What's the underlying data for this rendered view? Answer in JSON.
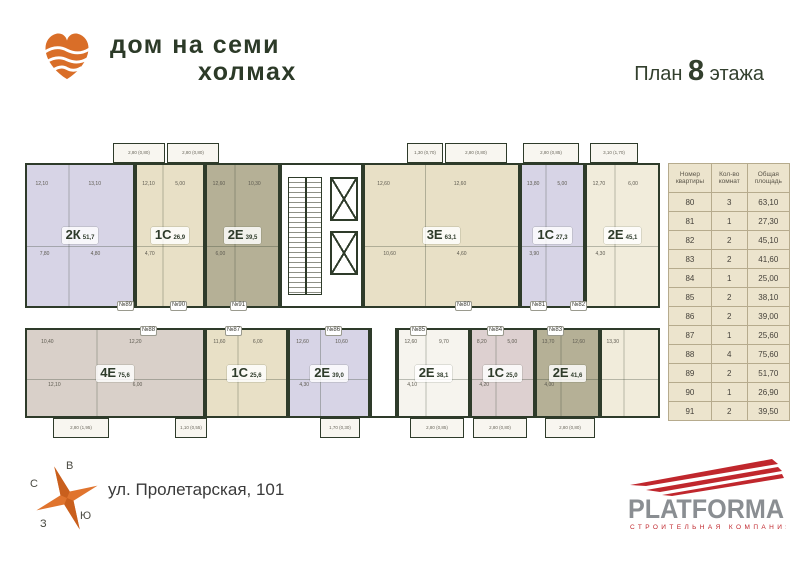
{
  "header": {
    "brand_line1": "дом на семи",
    "brand_line2": "холмах",
    "plan_prefix": "План",
    "plan_number": "8",
    "plan_suffix": "этажа"
  },
  "floor_plan": {
    "apartments": [
      {
        "door": "№89",
        "type": "2К",
        "area": "51,7",
        "color": "lavender",
        "x": 0,
        "y": 20,
        "w": 110,
        "h": 145,
        "rooms": [
          "12,10",
          "13,10",
          "7,80",
          "4,80"
        ],
        "doorx": 92,
        "doory": 158
      },
      {
        "door": "№90",
        "type": "1С",
        "area": "26,9",
        "color": "beige",
        "x": 110,
        "y": 20,
        "w": 70,
        "h": 145,
        "rooms": [
          "12,10",
          "5,00",
          "4,70"
        ],
        "doorx": 145,
        "doory": 158
      },
      {
        "door": "№91",
        "type": "2Е",
        "area": "39,5",
        "color": "olive",
        "x": 180,
        "y": 20,
        "w": 75,
        "h": 145,
        "rooms": [
          "12,60",
          "10,30",
          "6,00"
        ],
        "doorx": 205,
        "doory": 158
      },
      {
        "door": "№80",
        "type": "3Е",
        "area": "63,1",
        "color": "beige",
        "x": 338,
        "y": 20,
        "w": 157,
        "h": 145,
        "rooms": [
          "12,60",
          "12,60",
          "10,60",
          "4,60"
        ],
        "doorx": 430,
        "doory": 158
      },
      {
        "door": "№81",
        "type": "1С",
        "area": "27,3",
        "color": "lavender",
        "x": 495,
        "y": 20,
        "w": 65,
        "h": 145,
        "rooms": [
          "13,80",
          "5,00",
          "3,90"
        ],
        "doorx": 505,
        "doory": 158
      },
      {
        "door": "№82",
        "type": "2Е",
        "area": "45,1",
        "color": "cream",
        "x": 560,
        "y": 20,
        "w": 75,
        "h": 145,
        "rooms": [
          "12,70",
          "6,00",
          "4,30"
        ],
        "doorx": 545,
        "doory": 158
      },
      {
        "door": "№88",
        "type": "4Е",
        "area": "75,6",
        "color": "taupe",
        "x": 0,
        "y": 185,
        "w": 180,
        "h": 90,
        "rooms": [
          "10,40",
          "12,20",
          "12,10",
          "6,00"
        ],
        "doorx": 115,
        "doory": 183
      },
      {
        "door": "№87",
        "type": "1С",
        "area": "25,6",
        "color": "beige",
        "x": 180,
        "y": 185,
        "w": 83,
        "h": 90,
        "rooms": [
          "11,60",
          "6,00"
        ],
        "doorx": 200,
        "doory": 183
      },
      {
        "door": "№86",
        "type": "2Е",
        "area": "39,0",
        "color": "lavender",
        "x": 263,
        "y": 185,
        "w": 82,
        "h": 90,
        "rooms": [
          "12,60",
          "10,60",
          "4,30"
        ],
        "doorx": 300,
        "doory": 183
      },
      {
        "door": "№85",
        "type": "2Е",
        "area": "38,1",
        "color": "white",
        "x": 372,
        "y": 185,
        "w": 73,
        "h": 90,
        "rooms": [
          "12,60",
          "9,70",
          "4,10"
        ],
        "doorx": 385,
        "doory": 183
      },
      {
        "door": "№84",
        "type": "1С",
        "area": "25,0",
        "color": "pink",
        "x": 445,
        "y": 185,
        "w": 65,
        "h": 90,
        "rooms": [
          "8,20",
          "5,00",
          "4,20"
        ],
        "doorx": 462,
        "doory": 183
      },
      {
        "door": "№83",
        "type": "2Е",
        "area": "41,6",
        "color": "olive",
        "x": 510,
        "y": 185,
        "w": 65,
        "h": 90,
        "rooms": [
          "13,70",
          "12,60",
          "4,00"
        ],
        "doorx": 522,
        "doory": 183
      }
    ],
    "extra_blocks": [
      {
        "color": "cream",
        "x": 575,
        "y": 185,
        "w": 60,
        "h": 90,
        "rooms": [
          "13,30"
        ]
      }
    ],
    "lobby": {
      "x": 345,
      "y": 185,
      "w": 27,
      "h": 90
    },
    "balconies_top": [
      {
        "x": 88,
        "w": 52,
        "label": "2,80 (0,80)"
      },
      {
        "x": 142,
        "w": 52,
        "label": "2,80 (0,80)"
      },
      {
        "x": 382,
        "w": 36,
        "label": "1,30 (0,70)"
      },
      {
        "x": 420,
        "w": 62,
        "label": "2,80 (0,80)"
      },
      {
        "x": 498,
        "w": 56,
        "label": "2,80 (0,85)"
      },
      {
        "x": 565,
        "w": 48,
        "label": "3,10 (1,70)"
      }
    ],
    "balconies_bottom": [
      {
        "x": 28,
        "w": 56,
        "label": "2,80 (1,95)"
      },
      {
        "x": 150,
        "w": 32,
        "label": "1,10 (0,55)"
      },
      {
        "x": 295,
        "w": 40,
        "label": "1,70 (0,30)"
      },
      {
        "x": 385,
        "w": 54,
        "label": "2,80 (0,85)"
      },
      {
        "x": 448,
        "w": 54,
        "label": "2,80 (0,80)"
      },
      {
        "x": 520,
        "w": 50,
        "label": "2,80 (0,80)"
      }
    ],
    "apt_colors": {
      "lavender": "#d7d4e6",
      "beige": "#e8e0c6",
      "olive": "#b5b096",
      "cream": "#f1ecdb",
      "taupe": "#d9d0c9",
      "white": "#f6f4ee",
      "pink": "#ddd0d0"
    }
  },
  "table": {
    "headers": [
      "Номер квартиры",
      "Кол-во комнат",
      "Общая площадь"
    ],
    "rows": [
      [
        "80",
        "3",
        "63,10"
      ],
      [
        "81",
        "1",
        "27,30"
      ],
      [
        "82",
        "2",
        "45,10"
      ],
      [
        "83",
        "2",
        "41,60"
      ],
      [
        "84",
        "1",
        "25,00"
      ],
      [
        "85",
        "2",
        "38,10"
      ],
      [
        "86",
        "2",
        "39,00"
      ],
      [
        "87",
        "1",
        "25,60"
      ],
      [
        "88",
        "4",
        "75,60"
      ],
      [
        "89",
        "2",
        "51,70"
      ],
      [
        "90",
        "1",
        "26,90"
      ],
      [
        "91",
        "2",
        "39,50"
      ]
    ]
  },
  "footer": {
    "address": "ул. Пролетарская, 101",
    "compass": {
      "north": "С",
      "east": "В",
      "west": "З",
      "south": "Ю"
    },
    "developer": {
      "name": "PLATFORMA",
      "tagline": "СТРОИТЕЛЬНАЯ КОМПАНИЯ"
    }
  },
  "colors": {
    "wall": "#2e3b2a",
    "brand_green": "#2c3a28",
    "logo_orange": "#d96e28",
    "compass_orange": "#e0742e",
    "platforma_red": "#c0272d",
    "platforma_gray": "#8a8e92"
  }
}
